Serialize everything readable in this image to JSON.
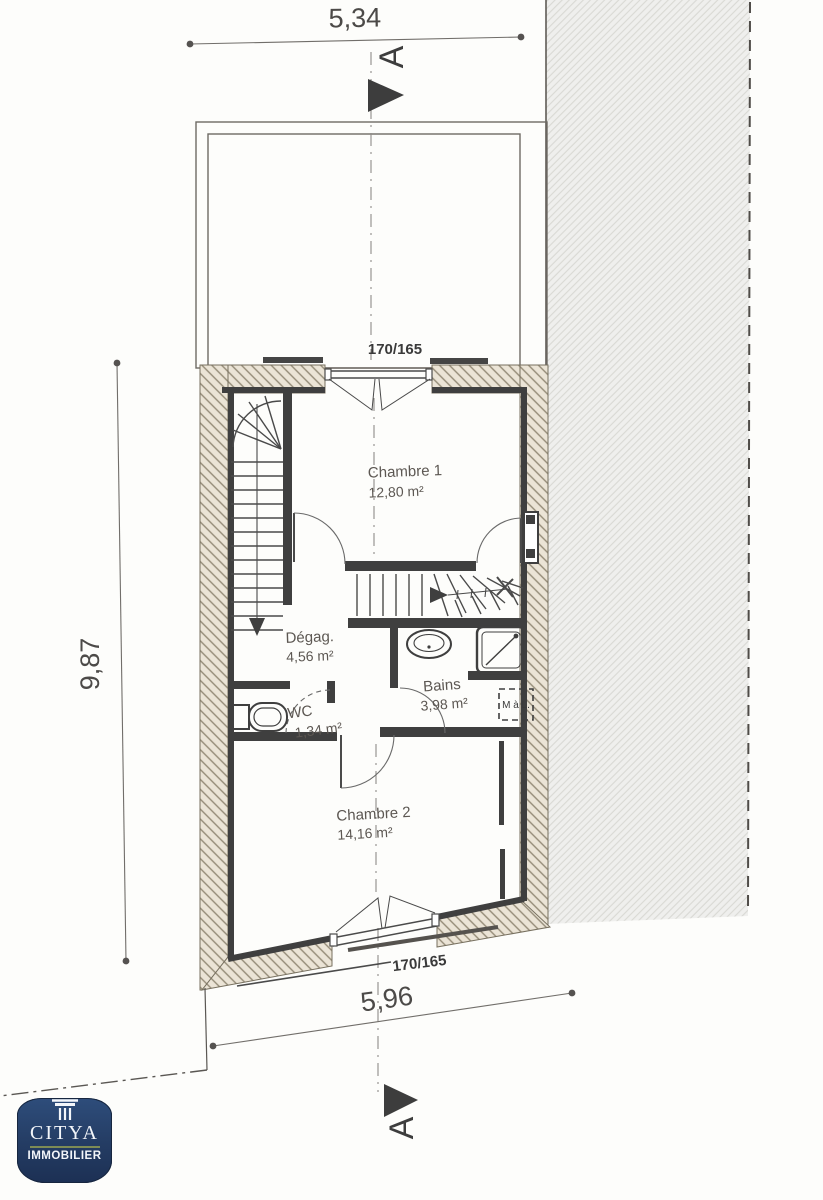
{
  "plan": {
    "dimensions": {
      "top_width": "5,34",
      "left_height": "9,87",
      "bottom_width": "5,96"
    },
    "windows": {
      "top_label": "170/165",
      "bottom_label": "170/165"
    },
    "section_marker": {
      "top": "A",
      "bottom": "A"
    },
    "rooms": {
      "chambre1": {
        "name": "Chambre 1",
        "area": "12,80 m²"
      },
      "degagement": {
        "name": "Dégag.",
        "area": "4,56 m²"
      },
      "wc": {
        "name": "WC",
        "area": "1,34 m²"
      },
      "bains": {
        "name": "Bains",
        "area": "3,98 m²"
      },
      "chambre2": {
        "name": "Chambre 2",
        "area": "14,16 m²"
      }
    },
    "appliances": {
      "washing_machine": "M à L."
    }
  },
  "logo": {
    "brand": "CITYA",
    "tagline": "IMMOBILIER"
  },
  "colors": {
    "dark_wall": "#3f3f3f",
    "wall_hatch_line": "#948b77",
    "neighbor_fill": "#efefed",
    "logo_navy": "#243c63",
    "logo_olive": "#7e8c55"
  }
}
